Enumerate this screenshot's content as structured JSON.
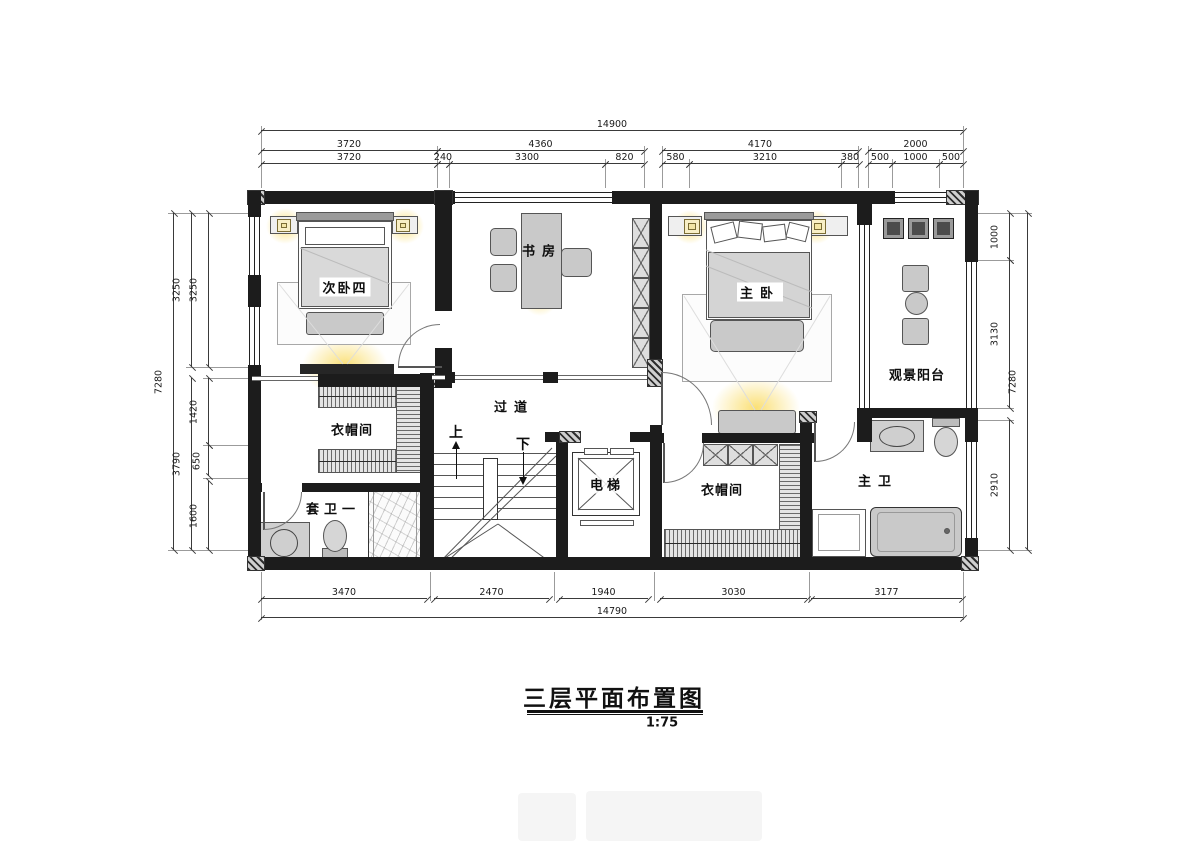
{
  "title": {
    "text": "三层平面布置图",
    "scale": "1:75"
  },
  "rooms": {
    "bedroom4": "次卧四",
    "study": "书房",
    "master_bedroom": "主卧",
    "balcony": "观景阳台",
    "closet_left": "衣帽间",
    "closet_right": "衣帽间",
    "corridor": "过道",
    "ensuite_bath1": "套卫一",
    "master_bath": "主卫",
    "elevator": "电梯",
    "stair_up": "上",
    "stair_down": "下"
  },
  "dimensions": {
    "top_overall": "14900",
    "top_row2": [
      "3720",
      "4360",
      "4170",
      "2000"
    ],
    "top_row3": [
      "3720",
      "240",
      "3300",
      "820",
      "580",
      "3210",
      "380",
      "500",
      "1000",
      "500"
    ],
    "bottom_row": [
      "3470",
      "2470",
      "1940",
      "3030",
      "3177"
    ],
    "bottom_overall": "14790",
    "left_overall": "7280",
    "left_mid": [
      "3250",
      "3790"
    ],
    "left_inner": [
      "3250",
      "1420",
      "650",
      "1600"
    ],
    "right_inner": [
      "1000",
      "3130",
      "2910"
    ],
    "right_overall": "7280"
  },
  "colors": {
    "wall": "#1c1c1c",
    "furniture": "#c9c9c9",
    "glow": "#fade6e",
    "line": "#3a3a3a"
  }
}
